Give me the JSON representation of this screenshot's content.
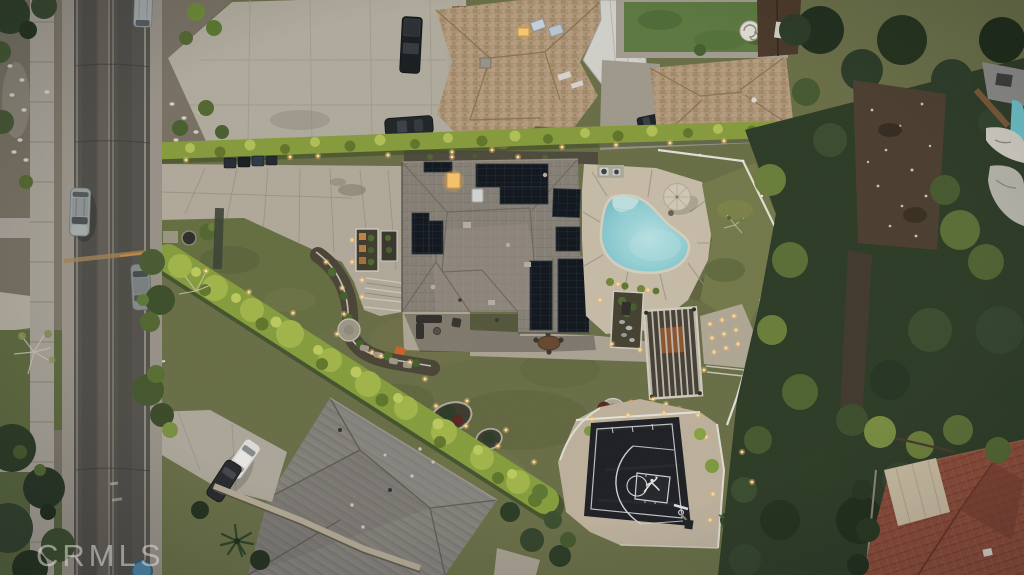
{
  "watermark": {
    "text": "CRMLS"
  },
  "scene": {
    "type": "aerial-drone-photo",
    "subject": "residential property at dusk with solar-panel roof, freeform pool, pergola and basketball court",
    "palette": {
      "asphalt": "#56524b",
      "concrete_driveway": "#b7ae9d",
      "sidewalk": "#a9a397",
      "lawn_olive": "#6b7045",
      "hedge_bright": "#a7bb49",
      "dark_trees": "#2c3a23",
      "main_roof_gray": "#8a8277",
      "neighbor_roof_tan": "#b29877",
      "bottom_roof_gray": "#85817a",
      "red_tile_roof": "#8e4a36",
      "pool_water": "#8fd2d8",
      "pool_deck_tan": "#cdc1ab",
      "court_surface": "#1d1d21",
      "court_lines": "#d9d9d9",
      "solar_panel": "#0f141a",
      "landscape_light": "#ffcf7e",
      "fence_white": "#ebe7dc"
    },
    "features": [
      "street",
      "sidewalk",
      "parked-cars",
      "front-driveway",
      "main-house-solar-roof",
      "swimming-pool",
      "pool-steps",
      "pool-deck",
      "patio-umbrella",
      "ac-units",
      "pergola-dining",
      "recessed-light-patio",
      "fire-pit-lounge",
      "basketball-court",
      "jumpman-logo",
      "basketball-hoop",
      "landscape-hedges-with-lights",
      "front-entry-planters",
      "island-planting-beds",
      "second-house",
      "neighbor-homes",
      "neighbor-pool",
      "dirt-clearing",
      "trees",
      "crmls-watermark"
    ]
  }
}
